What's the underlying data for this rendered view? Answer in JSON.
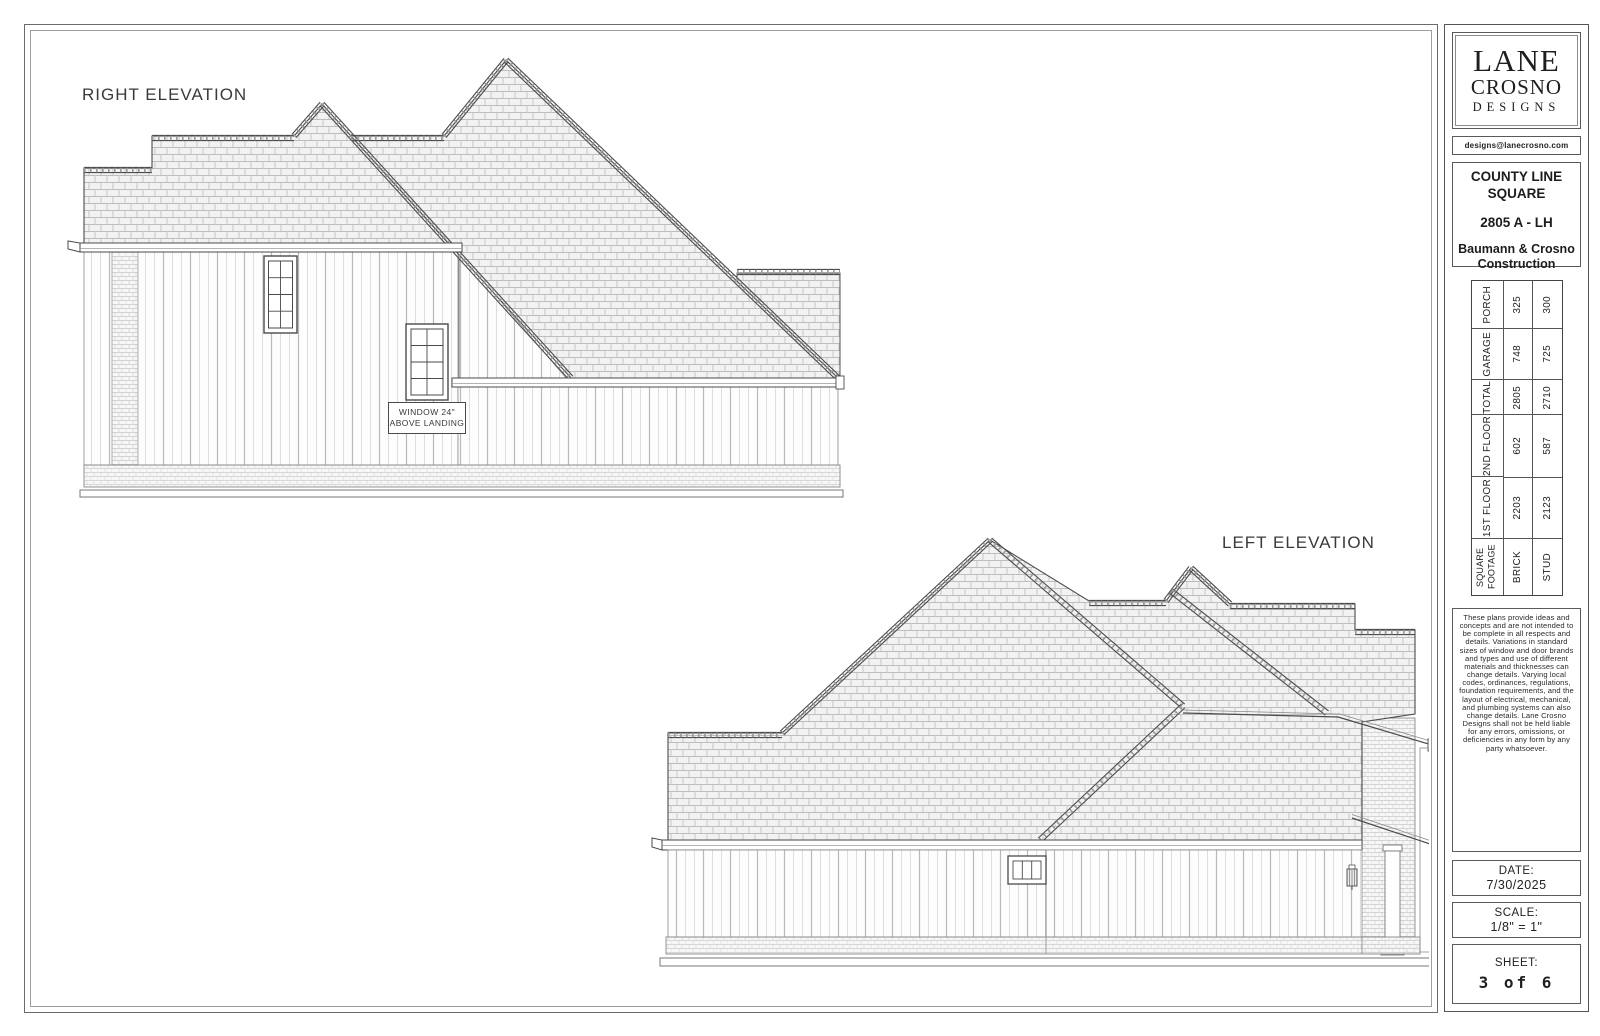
{
  "drawing": {
    "right_elevation_title": "RIGHT ELEVATION",
    "left_elevation_title": "LEFT ELEVATION",
    "window_note_line1": "WINDOW 24\"",
    "window_note_line2": "ABOVE LANDING"
  },
  "title_block": {
    "logo_line1": "LANE",
    "logo_line2": "CROSNO",
    "logo_line3": "DESIGNS",
    "email": "designs@lanecrosno.com",
    "project_name": "COUNTY LINE SQUARE",
    "plan_number": "2805 A - LH",
    "builder": "Baumann & Crosno Construction"
  },
  "sqft_table": {
    "header": "SQUARE FOOTAGE",
    "col_brick": "BRICK",
    "col_stud": "STUD",
    "rows": [
      {
        "label": "PORCH",
        "brick": "325",
        "stud": "300"
      },
      {
        "label": "GARAGE",
        "brick": "748",
        "stud": "725"
      },
      {
        "label": "TOTAL",
        "brick": "2805",
        "stud": "2710"
      },
      {
        "label": "2ND FLOOR",
        "brick": "602",
        "stud": "587"
      },
      {
        "label": "1ST FLOOR",
        "brick": "2203",
        "stud": "2123"
      }
    ]
  },
  "disclaimer": "These plans provide ideas and concepts and are not intended to be complete in all respects and details. Variations in standard sizes of window and door brands and types and use of different materials and thicknesses can change details. Varying local codes, ordinances, regulations, foundation requirements, and the layout of electrical, mechanical, and plumbing systems can also change details. Lane Crosno Designs shall not be held liable for any errors, omissions, or deficiencies in any form by any party whatsoever.",
  "stamps": {
    "date_label": "DATE:",
    "date_value": "7/30/2025",
    "scale_label": "SCALE:",
    "scale_value": "1/8\" = 1\"",
    "sheet_label": "SHEET:",
    "sheet_value": "3 of 6"
  },
  "colors": {
    "line": "#4a4a4a",
    "roof_hatch": "#bdbdbd",
    "roof_fill": "#f2f2f2",
    "paper": "#ffffff"
  }
}
